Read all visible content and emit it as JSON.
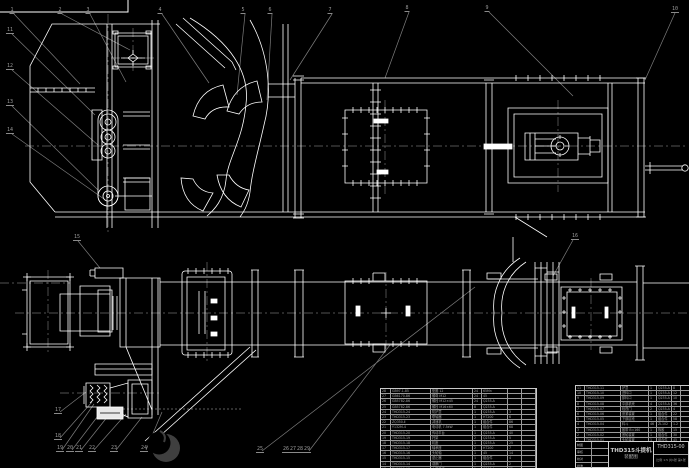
{
  "colors": {
    "background": "#000000",
    "geometry": "#ffffff",
    "annotation_gray": "#7d7d7d",
    "table_text": "#a5a5a5",
    "watermark": "#3f3f3f"
  },
  "title_block": {
    "product_name": "THD315斗提机",
    "drawing_type": "装配图",
    "drawing_number": "THD315-00",
    "scale_note": "比例 1:5  共1张 第1张",
    "sign_rows": [
      {
        "label": "制图",
        "value": ""
      },
      {
        "label": "审核",
        "value": ""
      },
      {
        "label": "校对",
        "value": ""
      },
      {
        "label": "批准",
        "value": ""
      }
    ]
  },
  "bom": {
    "right": {
      "header": [
        "序号",
        "代  号",
        "名  称",
        "数量",
        "材  料",
        "重量",
        "备注"
      ],
      "rows": [
        [
          "11",
          "THD315-11",
          "护罩",
          "1",
          "Q235-A",
          "8",
          ""
        ],
        [
          "10",
          "THD315-10",
          "进料口",
          "1",
          "Q235-A",
          "12",
          ""
        ],
        [
          "9",
          "THD315-09",
          "卸料口",
          "1",
          "Q235-A",
          "10",
          ""
        ],
        [
          "8",
          "THD315-08",
          "中部机壳",
          "4",
          "Q235-A",
          "36",
          ""
        ],
        [
          "7",
          "THD315-07",
          "检视门",
          "2",
          "Q235-A",
          "4",
          ""
        ],
        [
          "6",
          "THD315-06",
          "张紧装置",
          "1",
          "组合件",
          "22",
          ""
        ],
        [
          "5",
          "THD315-05",
          "下部区段",
          "1",
          "组合件",
          "58",
          ""
        ],
        [
          "4",
          "THD315-04",
          "料斗",
          "46",
          "ZL102",
          "1.2",
          ""
        ],
        [
          "3",
          "THD315-03",
          "胶带 B=160",
          "1",
          "橡胶",
          "15",
          ""
        ],
        [
          "2",
          "THD315-02",
          "底轮装置",
          "1",
          "组合件",
          "30",
          ""
        ],
        [
          "1",
          "THD315-01",
          "头轮装置",
          "1",
          "组合件",
          "45",
          ""
        ]
      ]
    },
    "left": {
      "rows": [
        [
          "28",
          "GB97.1-85",
          "垫圈 12",
          "24",
          "65Mn",
          "",
          ""
        ],
        [
          "27",
          "GB6170-86",
          "螺母 M12",
          "24",
          "45",
          "",
          ""
        ],
        [
          "26",
          "GB5782-86",
          "螺栓 M12×45",
          "24",
          "Q235-A",
          "",
          ""
        ],
        [
          "25",
          "GB5782-86",
          "螺栓 M16×60",
          "8",
          "Q235-A",
          "",
          ""
        ],
        [
          "24",
          "THD315-24",
          "防护罩",
          "1",
          "Q235-A",
          "3",
          ""
        ],
        [
          "23",
          "THD315-23",
          "联轴器",
          "1",
          "HT200",
          "6",
          ""
        ],
        [
          "22",
          "ZQ350-Ⅱ",
          "减速机",
          "1",
          "组合件",
          "86",
          ""
        ],
        [
          "21",
          "Y132M-4",
          "电动机 7.5kW",
          "1",
          "组合件",
          "68",
          ""
        ],
        [
          "20",
          "THD315-20",
          "传动平台",
          "1",
          "Q235-A",
          "40",
          ""
        ],
        [
          "19",
          "THD315-19",
          "托架",
          "2",
          "Q235-A",
          "5",
          ""
        ],
        [
          "18",
          "THD315-18",
          "机座",
          "1",
          "Q235-A",
          "25",
          ""
        ],
        [
          "17",
          "THD315-17",
          "轴承座",
          "2",
          "HT200",
          "7",
          ""
        ],
        [
          "16",
          "THD315-16",
          "头轮轴",
          "1",
          "45",
          "14",
          ""
        ],
        [
          "15",
          "THD315-15",
          "逆止器",
          "1",
          "组合件",
          "4",
          ""
        ],
        [
          "14",
          "THD315-14",
          "观察门",
          "1",
          "Q235-A",
          "2",
          ""
        ],
        [
          "13",
          "THD315-13",
          "上部机壳",
          "1",
          "Q235-A",
          "32",
          ""
        ],
        [
          "12",
          "THD315-12",
          "中间法兰",
          "6",
          "Q235-A",
          "2",
          ""
        ]
      ]
    }
  },
  "balloons": [
    {
      "n": "1",
      "x": 12,
      "y": 14
    },
    {
      "n": "2",
      "x": 60,
      "y": 14
    },
    {
      "n": "3",
      "x": 88,
      "y": 14
    },
    {
      "n": "4",
      "x": 160,
      "y": 14
    },
    {
      "n": "5",
      "x": 243,
      "y": 14
    },
    {
      "n": "6",
      "x": 270,
      "y": 14
    },
    {
      "n": "7",
      "x": 330,
      "y": 14
    },
    {
      "n": "8",
      "x": 407,
      "y": 12
    },
    {
      "n": "9",
      "x": 487,
      "y": 12
    },
    {
      "n": "10",
      "x": 675,
      "y": 13
    },
    {
      "n": "11",
      "x": 10,
      "y": 34
    },
    {
      "n": "12",
      "x": 10,
      "y": 70
    },
    {
      "n": "13",
      "x": 10,
      "y": 106
    },
    {
      "n": "14",
      "x": 10,
      "y": 134
    },
    {
      "n": "15",
      "x": 77,
      "y": 241
    },
    {
      "n": "16",
      "x": 575,
      "y": 240
    },
    {
      "n": "17",
      "x": 58,
      "y": 414
    },
    {
      "n": "18",
      "x": 58,
      "y": 440
    },
    {
      "n": "19",
      "x": 60,
      "y": 452
    },
    {
      "n": "20",
      "x": 70,
      "y": 452
    },
    {
      "n": "21",
      "x": 79,
      "y": 452
    },
    {
      "n": "22",
      "x": 92,
      "y": 452
    },
    {
      "n": "23",
      "x": 114,
      "y": 452
    },
    {
      "n": "24",
      "x": 144,
      "y": 452
    },
    {
      "n": "25",
      "x": 260,
      "y": 453
    },
    {
      "n": "26",
      "x": 286,
      "y": 453
    },
    {
      "n": "27",
      "x": 293,
      "y": 453
    },
    {
      "n": "28",
      "x": 300,
      "y": 453
    },
    {
      "n": "29",
      "x": 307,
      "y": 453
    }
  ]
}
